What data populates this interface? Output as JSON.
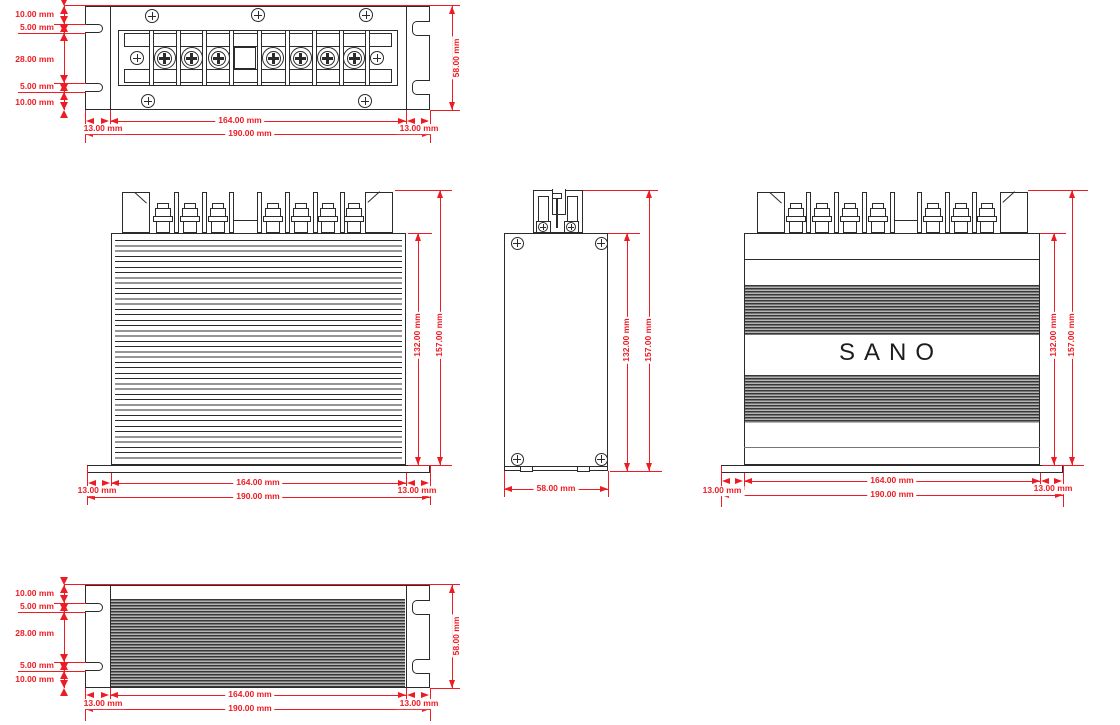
{
  "brand": "SANO",
  "dims": {
    "d10": "10.00 mm",
    "d5": "5.00 mm",
    "d28": "28.00 mm",
    "d13": "13.00 mm",
    "d58": "58.00 mm",
    "d132": "132.00 mm",
    "d157": "157.00 mm",
    "d164": "164.00 mm",
    "d190": "190.00 mm"
  },
  "colors": {
    "dimension_red": "#ed1c24",
    "line_dark": "#2b2b2b"
  }
}
